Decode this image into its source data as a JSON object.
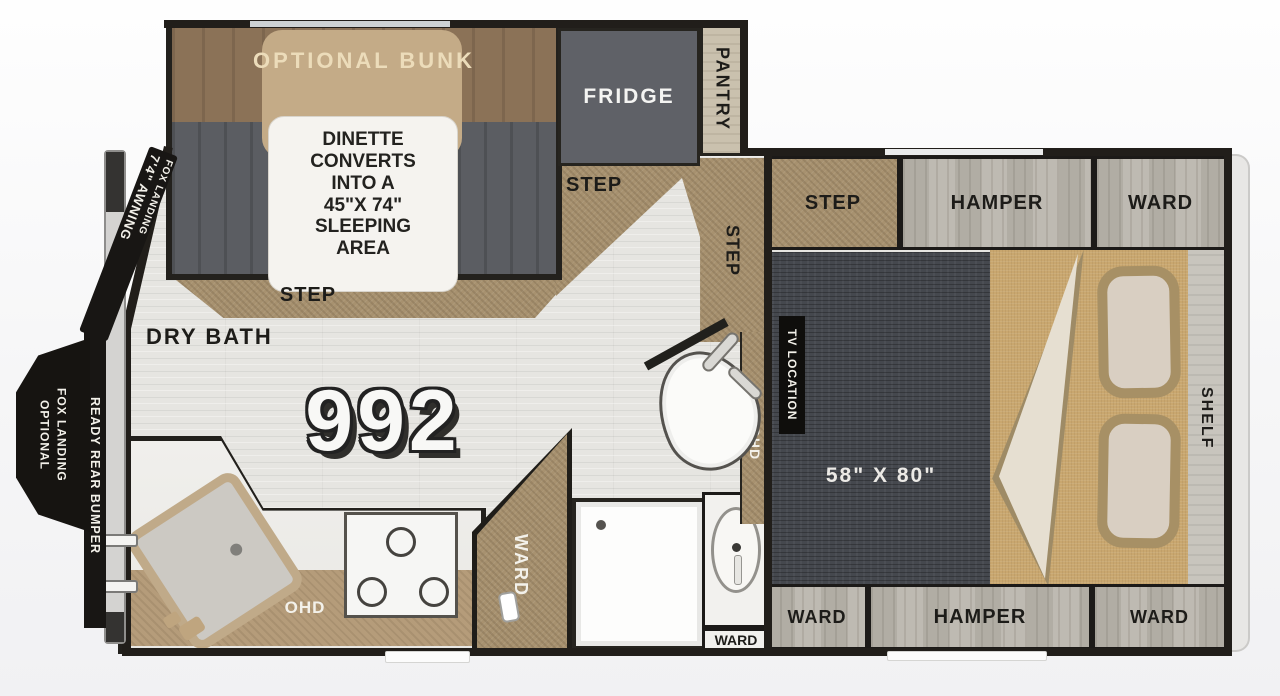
{
  "model_number": "992",
  "palette": {
    "wall": "#211e1a",
    "step_tan": "#a7916f",
    "wood_gray": "#bab6ad",
    "seat_gray": "#5b5d62",
    "backrest_brown": "#8b7257",
    "table_tan": "#c4ab87",
    "fridge_gray": "#5f6167",
    "bed_dark": "#45484e",
    "bedding_tan": "#c9a76f",
    "floor_gray": "#e6e5e1",
    "label_cream": "#ecdcba"
  },
  "dinette": {
    "bunk_label": "OPTIONAL BUNK",
    "note": "DINETTE\nCONVERTS\nINTO A\n45\"X 74\"\nSLEEPING\nAREA",
    "step_label": "STEP"
  },
  "galley": {
    "fridge_label": "FRIDGE",
    "pantry_label": "PANTRY",
    "step_label": "STEP",
    "hall_step_label": "STEP",
    "ohd_label": "OHD"
  },
  "bath": {
    "dry_bath_label": "DRY BATH",
    "ward_wedge_label": "WARD",
    "ohd_label": "OHD",
    "vanity_ward_label": "WARD"
  },
  "bedroom": {
    "step_label": "STEP",
    "hamper_top_label": "HAMPER",
    "ward_top_label": "WARD",
    "bed_size_label": "58\" X 80\"",
    "tv_location_label": "TV LOCATION",
    "shelf_label": "SHELF",
    "ward_bottom_left_label": "WARD",
    "hamper_bottom_label": "HAMPER",
    "ward_bottom_right_label": "WARD"
  },
  "exterior": {
    "awning_label": "7'4\" AWNING",
    "fox_landing_label": "FOX LANDING",
    "rear_bumper_label": "READY REAR BUMPER",
    "optional_fox_landing_line1": "OPTIONAL",
    "optional_fox_landing_line2": "FOX LANDING"
  }
}
